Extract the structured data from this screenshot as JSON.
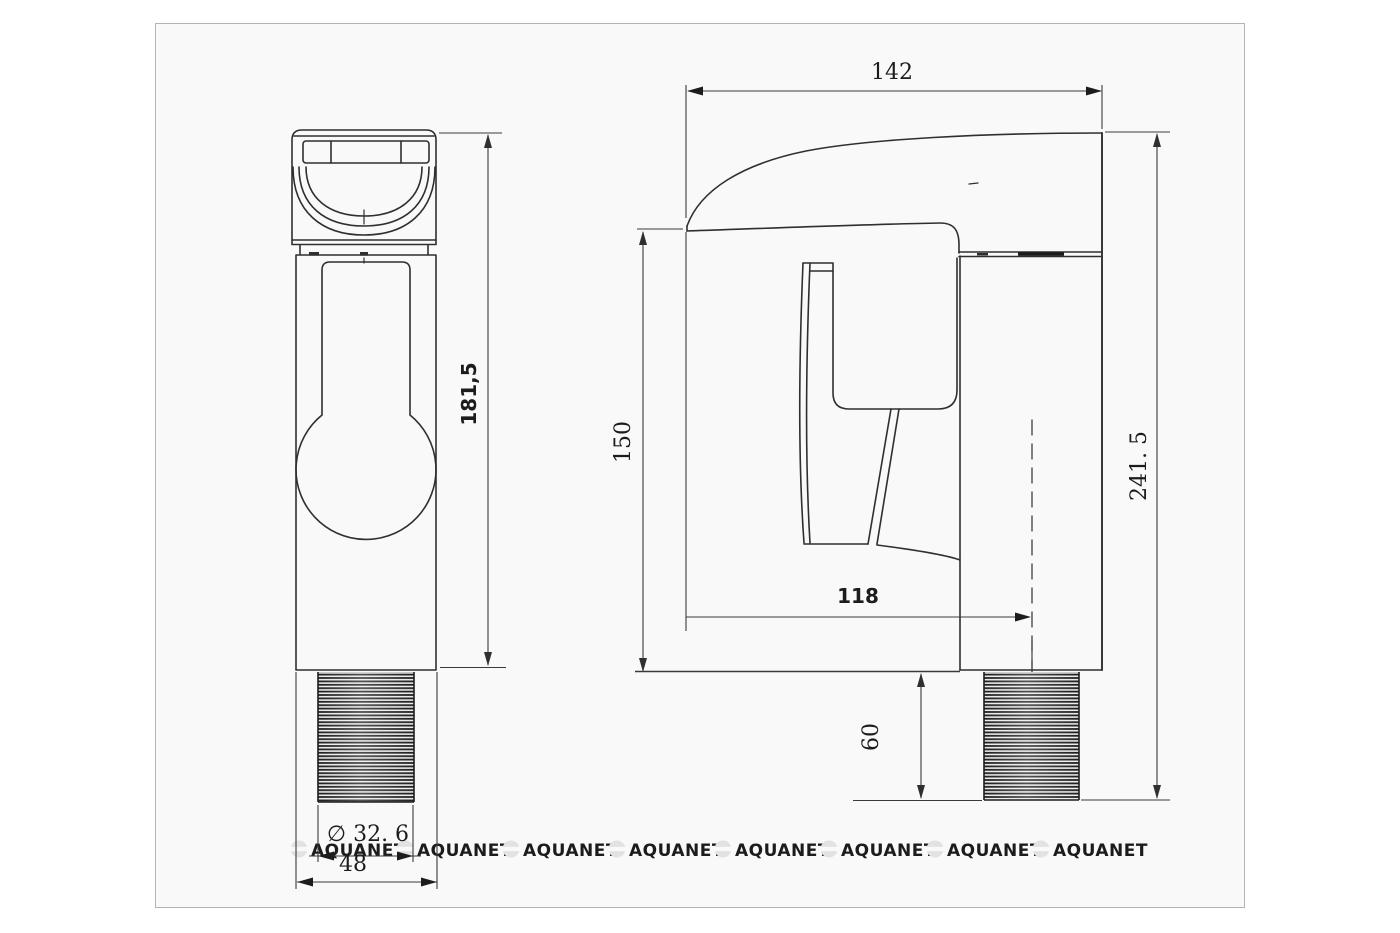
{
  "document": {
    "type": "technical-dimension-drawing",
    "subject": "basin waterfall faucet, front and side orthographic views"
  },
  "colors": {
    "page": "#ffffff",
    "sheet": "#f9f9f9",
    "sheet_border": "#b3b3b3",
    "line": "#2f2f2f",
    "dim": "#3a3a3a",
    "thread": "#1d1d1d",
    "watermark": "#e2e2e2"
  },
  "dims": {
    "front_height": "181,5",
    "front_thread_diameter": "∅ 32. 6",
    "front_base_width": "48",
    "side_reach": "142",
    "side_spout_height": "150",
    "side_base_depth": "118",
    "side_thread_length": "60",
    "side_total_height": "241. 5"
  },
  "watermark": {
    "label": "AQUANET",
    "count": 8
  }
}
